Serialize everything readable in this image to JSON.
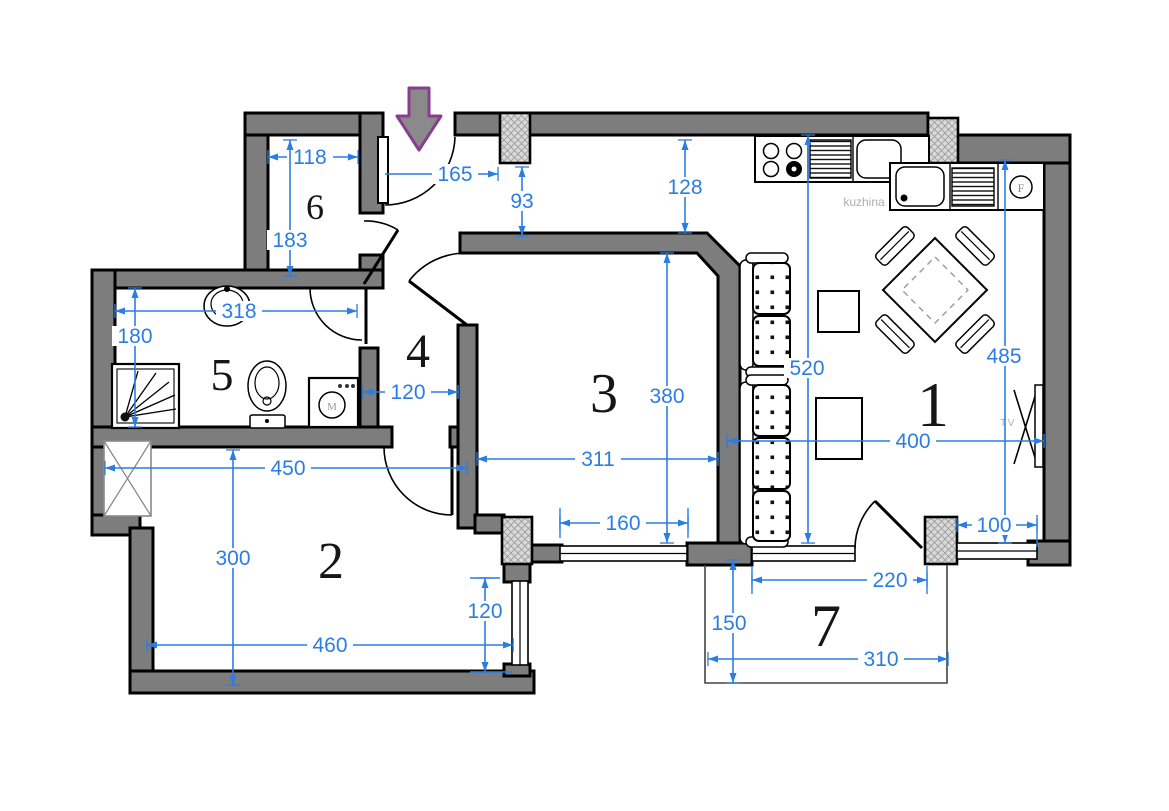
{
  "colors": {
    "wall_fill": "#7d7d7d",
    "outline": "#000000",
    "dimension_blue": "#2b7de2",
    "arrow_purple": "#8a3d8f",
    "column_hatch": "#d9d9d9",
    "label_gray": "#aeaeae"
  },
  "rooms": [
    {
      "number": "1"
    },
    {
      "number": "2"
    },
    {
      "number": "3"
    },
    {
      "number": "4"
    },
    {
      "number": "5"
    },
    {
      "number": "6"
    },
    {
      "number": "7"
    }
  ],
  "labels": {
    "kitchen": "kuzhina",
    "tv": "TV",
    "fridge": "F",
    "washer": "M"
  },
  "dimensions": [
    {
      "name": "room6-width",
      "value": "118"
    },
    {
      "name": "room6-height",
      "value": "183"
    },
    {
      "name": "entrance-width",
      "value": "165"
    },
    {
      "name": "corridor-gap",
      "value": "93"
    },
    {
      "name": "kitchen-gap",
      "value": "128"
    },
    {
      "name": "bath-width",
      "value": "318"
    },
    {
      "name": "bath-height",
      "value": "180"
    },
    {
      "name": "hall-width",
      "value": "120"
    },
    {
      "name": "room3-width",
      "value": "311"
    },
    {
      "name": "room3-height",
      "value": "380"
    },
    {
      "name": "living-height-left",
      "value": "520"
    },
    {
      "name": "living-height-right",
      "value": "485"
    },
    {
      "name": "living-width",
      "value": "400"
    },
    {
      "name": "window-right",
      "value": "100"
    },
    {
      "name": "room3-window",
      "value": "160"
    },
    {
      "name": "balcony-door-span",
      "value": "220"
    },
    {
      "name": "balcony-depth",
      "value": "150"
    },
    {
      "name": "balcony-width",
      "value": "310"
    },
    {
      "name": "room2-width-top",
      "value": "450"
    },
    {
      "name": "room2-height",
      "value": "300"
    },
    {
      "name": "room2-width-bottom",
      "value": "460"
    },
    {
      "name": "room2-window",
      "value": "120"
    }
  ]
}
